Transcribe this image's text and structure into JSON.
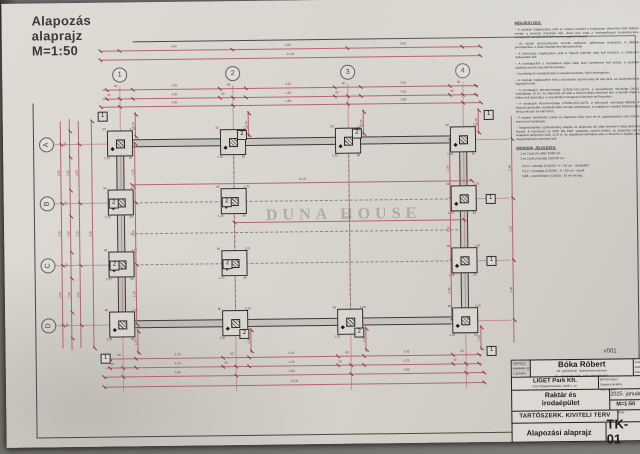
{
  "page_title": {
    "line1": "Alapozás",
    "line2": "alaprajz",
    "line3": "M=1:50"
  },
  "watermark": "DUNA HOUSE",
  "grid": {
    "columns": [
      "1",
      "2",
      "3",
      "4"
    ],
    "rows": [
      "A",
      "B",
      "C",
      "D"
    ]
  },
  "markers": {
    "m1": "1",
    "m2": "2"
  },
  "dims": {
    "overall_h": "14,40",
    "overall_b": "14,40",
    "overall_v": "9,05",
    "seg": [
      "4,80",
      "4,80",
      "4,80"
    ],
    "seg2": [
      "4,20",
      "4,25",
      "4,25"
    ],
    "mid": [
      "3,45",
      "3,45",
      "3,45"
    ],
    "vseg": [
      "2,95",
      "3,10",
      "3,00"
    ],
    "inner_v": [
      "2,35",
      "2,50",
      "2,40"
    ],
    "s30": "30",
    "s60": "60",
    "s120": "1,20",
    "inner_h": "14,10",
    "inner_h2": "9,25",
    "cluster": [
      "60",
      "1,20"
    ]
  },
  "notes": {
    "header": "MEGJEGYZÉS:",
    "items": [
      "A munkák megkezdése előtt az összes méretet a helyszínen ellenőrizni kell! Eltérés esetén a tervezőt értesíteni kell. Jelen terv csak a tartószerkezeti munkarészekre vonatkozik, az építész kiviteli tervvel együtt érvényes.",
      "Az épület tartószerkezete monolit vasbeton, pillérvázas rendszerű. A pillérek pontalapokra, a falak sávalapokra támaszkodnak.",
      "A betonozás megkezdése előtt a fogadó felületet meg kell tisztítani, a zsaluzatot nedvesíteni kell.",
      "A munkagödröt a munkálatok teljes ideje alatt víztelenítve kell tartani, a rézsűket szükség szerint meg kell támasztani.",
      "A pontalapok vasalását lásd a vasalási terveken, külön tervlapokon.",
      "A munkák megkezdése előtt a közművek nyomvonalát fel kell tárni, az üzemeltetőkkel egyeztetni kell.",
      "A pontalapok betonminősége C25/30-XC2-16-F3, a szerelőbeton minősége C8/10, vastagsága 10 cm. Az alapozási sík alatt a termett talajt tömöríteni kell, a kiemelt földet a telken kell deponálni, a visszatöltést rétegesen tömörítve kell készíteni.",
      "A sávalapok betonminősége C25/30-XC2-16-F3, a betonacél minősége B500B. A lábazati gerendák vasalását külön tervlap tartalmazza, a csatlakozó vasakat bebetonozás előtt pontosan be kell mérni.",
      "A talajvíz mértékadó szintje az alapozási síkot nem éri el, agresszivitása nem ismert, ezért nem mértékadó.",
      "Talajmechanikai szakvélemény alapján az alapozási sík alatti teherbíró réteg kavicsos homok. A méretezés az MSZ EN 1997 szabvány szerint történt, az alapozási sík a rendezett terepszint alatt -1,20 m. Az alapárkok kiemelése után a tervezőt a fogadó talaj megtekintésére értesíteni kell."
    ],
    "legend_header": "ANYAGOK, JELÖLÉSEK:",
    "legend_items": [
      "1 és 2 jelű vb. pillér 40/40 cm.",
      "1 és 2 jelű pontalap 120/120 cm."
    ],
    "material_items": [
      "S1,0 = sávalap (C16/20) · h = 40 cm · vasalatlan",
      "P1,2 = pontalap (C25/30) · h = 60 cm · vasalt",
      "SZB = szerelőbeton (C8/10) · 10 cm vastag"
    ]
  },
  "version": "v001",
  "titleblock": {
    "stamp_lines": [
      "TERVEZŐ",
      "KAMARAI SZ.",
      "T-13-0000"
    ],
    "designer_name": "Bóka Róbert",
    "designer_sub1": "okl. építőmérnök · tartószerkezeti tervező",
    "designer_sub2": "tel.: +36 30 000 0000 · boka.robert@mail.hu",
    "copy_lines": [
      "A terv szerzői jog-",
      "védelem alatt áll,",
      "másolni tilos!"
    ],
    "client_name": "LIGET Park Kft.",
    "client_sub": "2310 Szigetszentmiklós, Petőfi u. 10.",
    "site_lines": [
      "ÉPÍTÉSI HELY:",
      "Szigetszentmiklós,",
      "hrsz.: 1234/5"
    ],
    "project_line1": "Raktár és",
    "project_line2": "irodaépület",
    "date": "2025. január",
    "scale": "M=1:50",
    "phase": "TARTÓSZERK. KIVITELI TERV",
    "phase_right": "Rajz:",
    "drawing_title": "Alapozási alaprajz",
    "drawing_no": "TK-01"
  }
}
